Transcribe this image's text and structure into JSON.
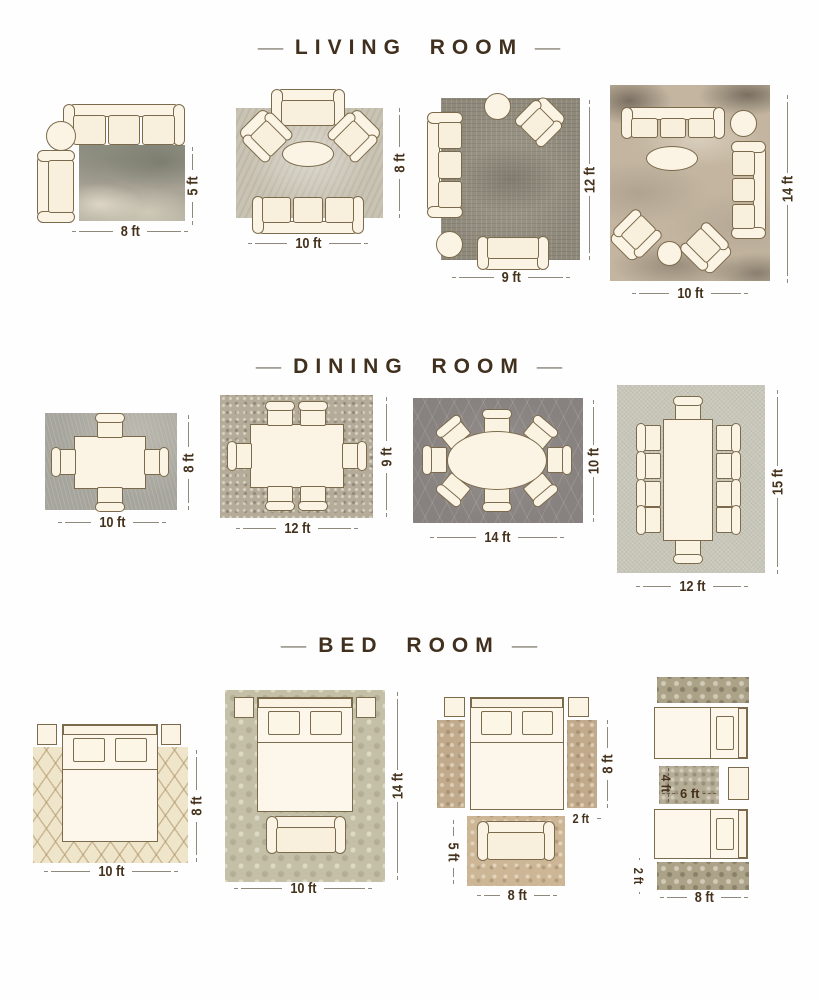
{
  "colors": {
    "title": "#41301d",
    "dimension_label": "#45321c",
    "dimension_line": "#8f897b",
    "furniture_fill": "#fbf4e4",
    "furniture_stroke": "#7c6a4c"
  },
  "sections": [
    {
      "title": "LIVING ROOM",
      "dash": "—",
      "diagrams": [
        {
          "w": "8 ft",
          "h": "5 ft"
        },
        {
          "w": "10 ft",
          "h": "8 ft"
        },
        {
          "w": "9 ft",
          "h": "12 ft"
        },
        {
          "w": "10 ft",
          "h": "14 ft"
        }
      ]
    },
    {
      "title": "DINING ROOM",
      "dash": "—",
      "diagrams": [
        {
          "w": "10 ft",
          "h": "8 ft"
        },
        {
          "w": "12 ft",
          "h": "9 ft"
        },
        {
          "w": "14 ft",
          "h": "10 ft"
        },
        {
          "w": "12 ft",
          "h": "15 ft"
        }
      ]
    },
    {
      "title": "BED ROOM",
      "dash": "—",
      "diagrams": [
        {
          "w": "10 ft",
          "h": "8 ft"
        },
        {
          "w": "10 ft",
          "h": "14 ft"
        },
        {
          "runner_h": "8 ft",
          "runner_w": "2 ft",
          "foot_h": "5 ft",
          "foot_w": "8 ft"
        },
        {
          "mid_h": "4 ft",
          "mid_w": "6 ft",
          "runner_h": "2 ft",
          "runner_w": "8 ft"
        }
      ]
    }
  ]
}
